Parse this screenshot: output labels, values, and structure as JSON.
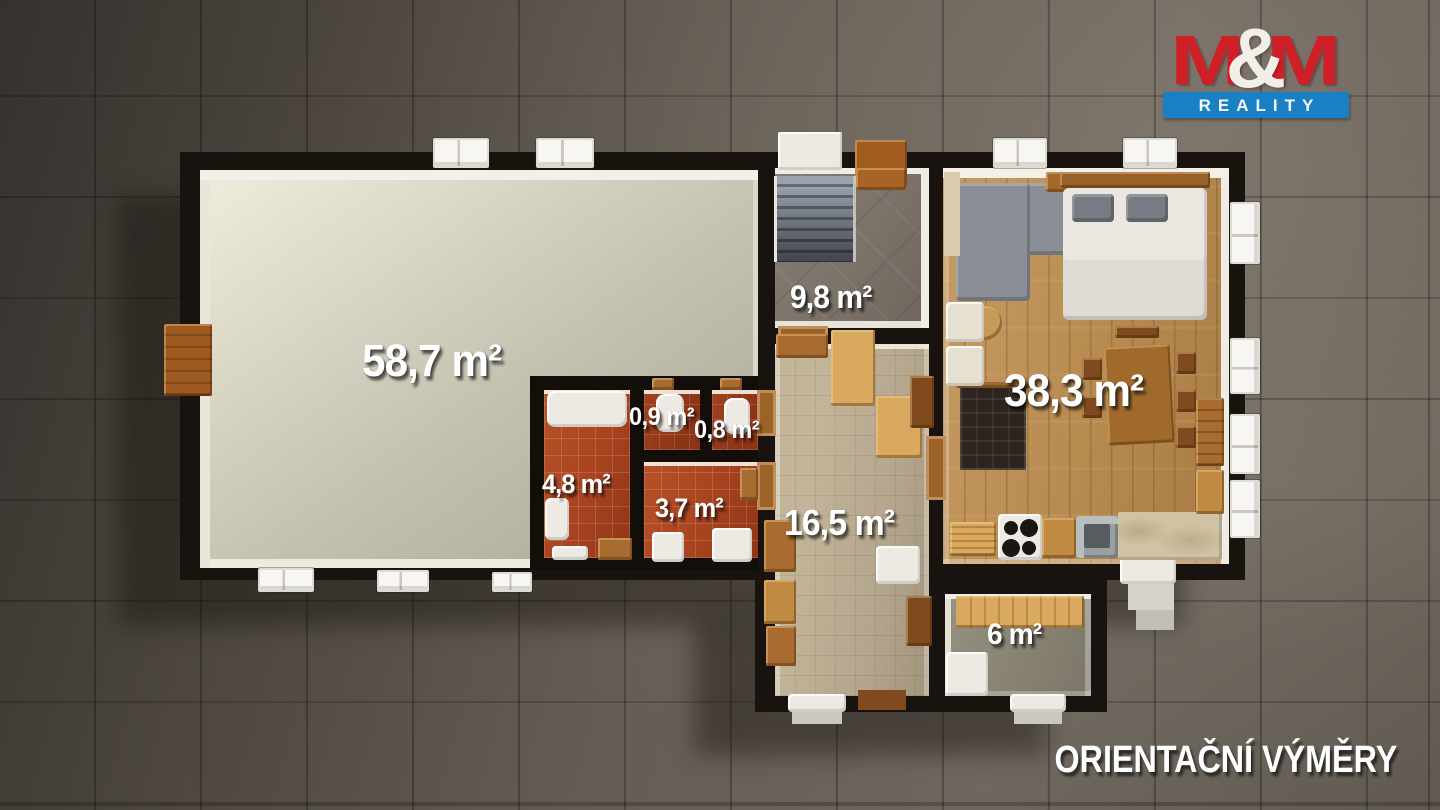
{
  "brand": {
    "m1": "M",
    "amp": "&",
    "m2": "M",
    "subtitle": "REALITY"
  },
  "rooms": {
    "living": {
      "label": "58,7 m²"
    },
    "entry": {
      "label": "9,8 m²"
    },
    "living_kitchen": {
      "label": "38,3 m²"
    },
    "wc_a": {
      "label": "0,9 m²"
    },
    "wc_b": {
      "label": "0,8 m²"
    },
    "bathroom": {
      "label": "4,8 m²"
    },
    "utility": {
      "label": "3,7 m²"
    },
    "hallway": {
      "label": "16,5 m²"
    },
    "storage": {
      "label": "6 m²"
    }
  },
  "footer": {
    "text": "ORIENTAČNÍ VÝMĚRY"
  },
  "colors": {
    "logo_red": "#d01f26",
    "logo_blue": "#1a80c5",
    "wall_black": "#18130e",
    "bath_tile_red": "#a8431f",
    "wood_floor": "#b98a54",
    "label_white": "#ffffff"
  }
}
